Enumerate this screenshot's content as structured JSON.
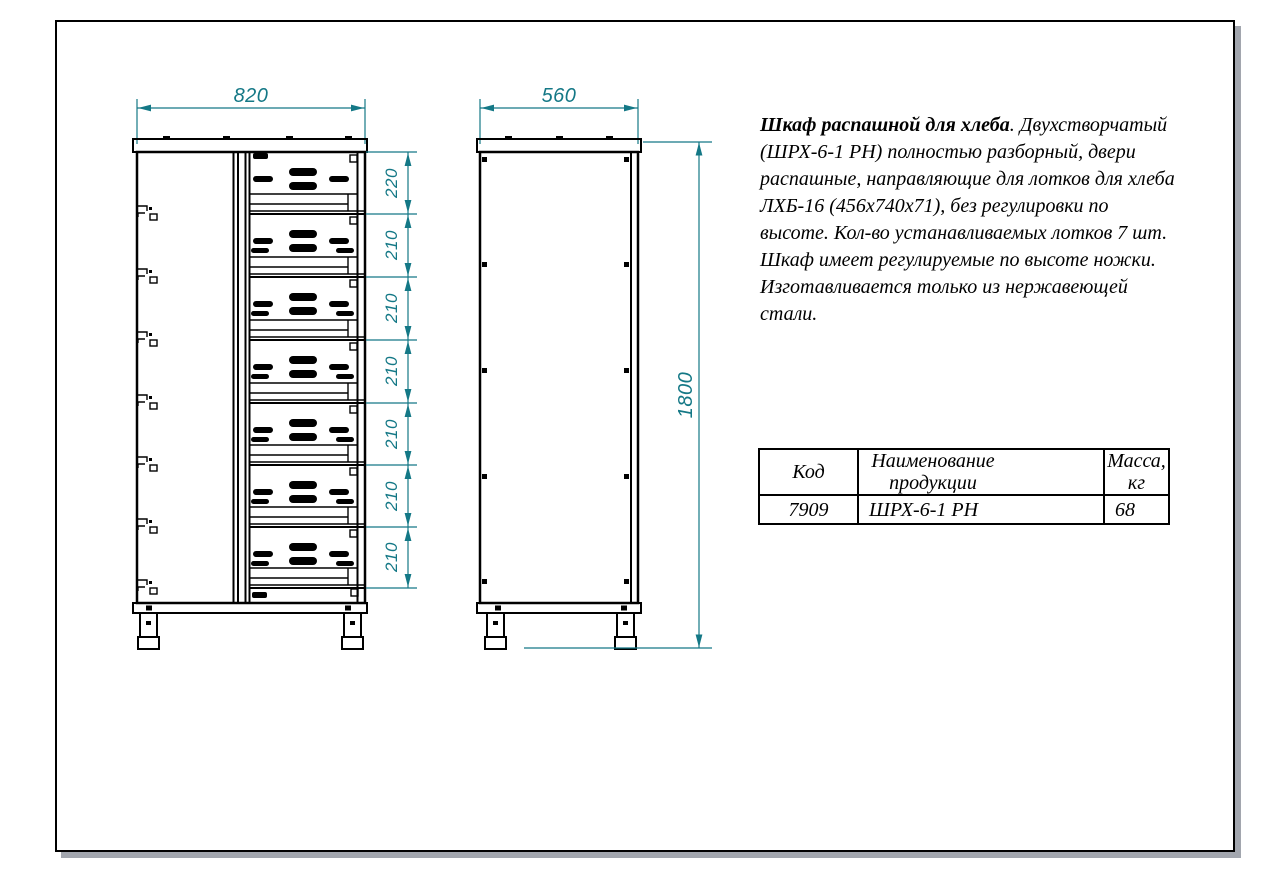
{
  "colors": {
    "dimension_teal": "#147886",
    "ink_black": "#000000",
    "sheet_shadow": "#a2a6ae"
  },
  "front_view": {
    "width_dim": "820",
    "shelf_dims": [
      "220",
      "210",
      "210",
      "210",
      "210",
      "210",
      "210"
    ]
  },
  "side_view": {
    "depth_dim": "560",
    "height_dim": "1800"
  },
  "description": {
    "title": "Шкаф распашной для хлеба",
    "lines": [
      ". Двухстворчатый",
      "(ШРХ-6-1 РН) полностью разборный, двери",
      "распашные, направляющие для лотков для хлеба",
      "ЛХБ-16 (456х740х71), без регулировки по",
      "высоте. Кол-во устанавливаемых лотков 7 шт.",
      "Шкаф имеет регулируемые по высоте ножки.",
      "Изготавливается только из нержавеющей",
      "стали."
    ]
  },
  "table": {
    "headers": [
      "Код",
      "Наименование продукции",
      "Масса, кг"
    ],
    "rows": [
      [
        "7909",
        "ШРХ-6-1 РН",
        "68"
      ]
    ]
  }
}
